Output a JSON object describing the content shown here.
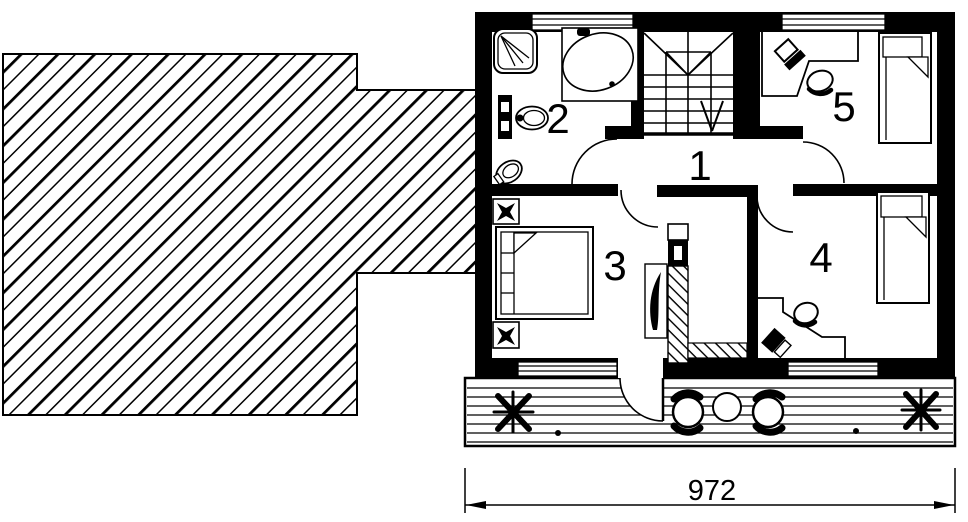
{
  "floor_plan": {
    "type": "architectural-floor-plan-upper-storey",
    "colors": {
      "ink": "#000000",
      "paper": "#ffffff"
    },
    "room_labels": [
      {
        "number": "1"
      },
      {
        "number": "2"
      },
      {
        "number": "3"
      },
      {
        "number": "4"
      },
      {
        "number": "5"
      }
    ],
    "dimension": {
      "value": "972"
    },
    "features": {
      "roof_area": "hatched-roof-plane-left",
      "stairs": "double-flight-with-winders-down-arrow",
      "bathroom_fixtures": [
        "shower-cabin",
        "corner-bathtub",
        "washbasin-with-cabinet",
        "toilet"
      ],
      "bedroom_furniture": [
        "double-bed",
        "two-nightstands"
      ],
      "room4_furniture": [
        "single-bed",
        "corner-desk-with-computer",
        "chair"
      ],
      "room5_furniture": [
        "single-bed",
        "corner-desk-with-computer",
        "chair"
      ],
      "terrace_items": [
        "plant",
        "plant",
        "two-armchairs",
        "round-table"
      ],
      "chimney": "flue-shaft-hatched"
    }
  }
}
